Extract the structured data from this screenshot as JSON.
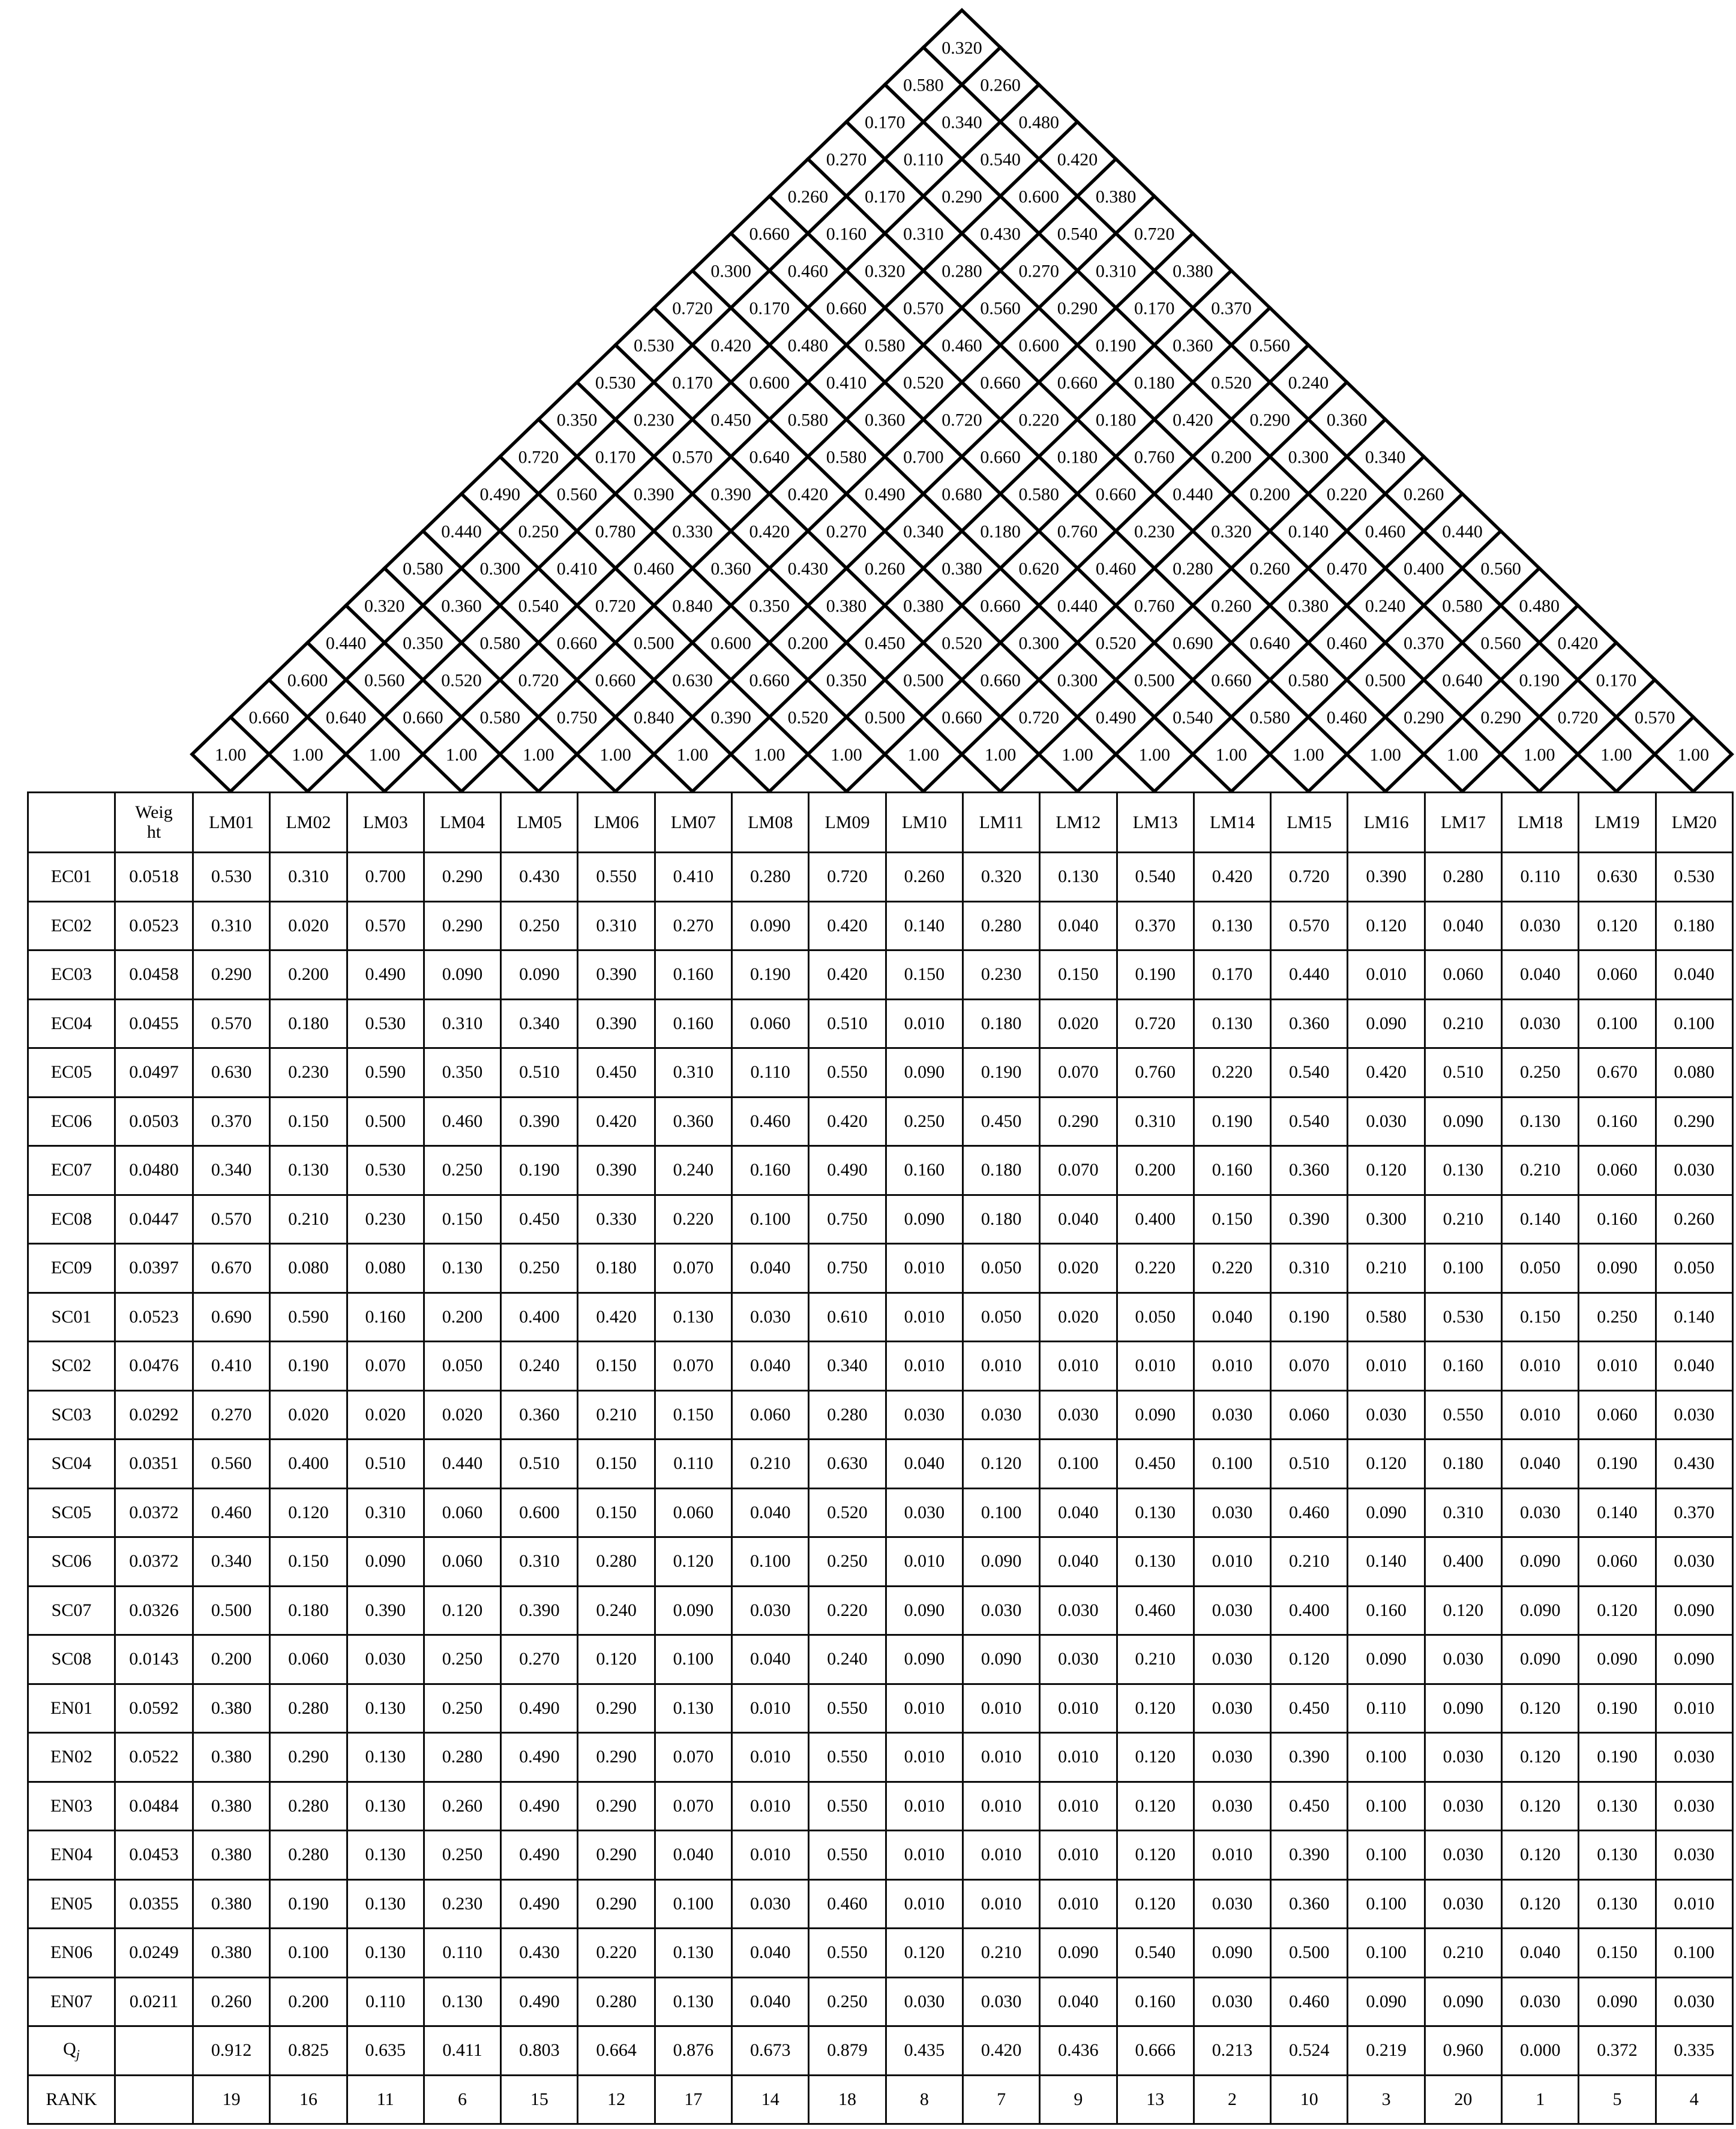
{
  "page": {
    "background": "#ffffff",
    "line_color": "#000000"
  },
  "roof": {
    "diagonal_label": "1.00",
    "rows_top_to_bottom": [
      [
        "0.320"
      ],
      [
        "0.580",
        "0.260"
      ],
      [
        "0.170",
        "0.340",
        "0.480"
      ],
      [
        "0.270",
        "0.110",
        "0.540",
        "0.420"
      ],
      [
        "0.260",
        "0.170",
        "0.290",
        "0.600",
        "0.380"
      ],
      [
        "0.660",
        "0.160",
        "0.310",
        "0.430",
        "0.540",
        "0.720"
      ],
      [
        "0.300",
        "0.460",
        "0.320",
        "0.280",
        "0.270",
        "0.310",
        "0.380"
      ],
      [
        "0.720",
        "0.170",
        "0.660",
        "0.570",
        "0.560",
        "0.290",
        "0.170",
        "0.370"
      ],
      [
        "0.530",
        "0.420",
        "0.480",
        "0.580",
        "0.460",
        "0.600",
        "0.190",
        "0.360",
        "0.560"
      ],
      [
        "0.530",
        "0.170",
        "0.600",
        "0.410",
        "0.520",
        "0.660",
        "0.660",
        "0.180",
        "0.520",
        "0.240"
      ],
      [
        "0.350",
        "0.230",
        "0.450",
        "0.580",
        "0.360",
        "0.720",
        "0.220",
        "0.180",
        "0.420",
        "0.290",
        "0.360"
      ],
      [
        "0.720",
        "0.170",
        "0.570",
        "0.640",
        "0.580",
        "0.700",
        "0.660",
        "0.180",
        "0.760",
        "0.200",
        "0.300",
        "0.340"
      ],
      [
        "0.490",
        "0.560",
        "0.390",
        "0.390",
        "0.420",
        "0.490",
        "0.680",
        "0.580",
        "0.660",
        "0.440",
        "0.200",
        "0.220",
        "0.260"
      ],
      [
        "0.440",
        "0.250",
        "0.780",
        "0.330",
        "0.420",
        "0.270",
        "0.340",
        "0.180",
        "0.760",
        "0.230",
        "0.320",
        "0.140",
        "0.460",
        "0.440"
      ],
      [
        "0.580",
        "0.300",
        "0.410",
        "0.460",
        "0.360",
        "0.430",
        "0.260",
        "0.380",
        "0.620",
        "0.460",
        "0.280",
        "0.260",
        "0.470",
        "0.400",
        "0.560"
      ],
      [
        "0.320",
        "0.360",
        "0.540",
        "0.720",
        "0.840",
        "0.350",
        "0.380",
        "0.380",
        "0.660",
        "0.440",
        "0.760",
        "0.260",
        "0.380",
        "0.240",
        "0.580",
        "0.480"
      ],
      [
        "0.440",
        "0.350",
        "0.580",
        "0.660",
        "0.500",
        "0.600",
        "0.200",
        "0.450",
        "0.520",
        "0.300",
        "0.520",
        "0.690",
        "0.640",
        "0.460",
        "0.370",
        "0.560",
        "0.420"
      ],
      [
        "0.600",
        "0.560",
        "0.520",
        "0.720",
        "0.660",
        "0.630",
        "0.660",
        "0.350",
        "0.500",
        "0.660",
        "0.300",
        "0.500",
        "0.660",
        "0.580",
        "0.500",
        "0.640",
        "0.190",
        "0.170"
      ],
      [
        "0.660",
        "0.640",
        "0.660",
        "0.580",
        "0.750",
        "0.840",
        "0.390",
        "0.520",
        "0.500",
        "0.660",
        "0.720",
        "0.490",
        "0.540",
        "0.580",
        "0.460",
        "0.290",
        "0.290",
        "0.720",
        "0.570"
      ]
    ],
    "base_row": [
      "1.00",
      "1.00",
      "1.00",
      "1.00",
      "1.00",
      "1.00",
      "1.00",
      "1.00",
      "1.00",
      "1.00",
      "1.00",
      "1.00",
      "1.00",
      "1.00",
      "1.00",
      "1.00",
      "1.00",
      "1.00",
      "1.00",
      "1.00"
    ]
  },
  "table": {
    "corner_label": "",
    "weight_header": "Weight",
    "column_headers": [
      "LM01",
      "LM02",
      "LM03",
      "LM04",
      "LM05",
      "LM06",
      "LM07",
      "LM08",
      "LM09",
      "LM10",
      "LM11",
      "LM12",
      "LM13",
      "LM14",
      "LM15",
      "LM16",
      "LM17",
      "LM18",
      "LM19",
      "LM20"
    ],
    "rows": [
      {
        "label": "EC01",
        "weight": "0.0518",
        "values": [
          "0.530",
          "0.310",
          "0.700",
          "0.290",
          "0.430",
          "0.550",
          "0.410",
          "0.280",
          "0.720",
          "0.260",
          "0.320",
          "0.130",
          "0.540",
          "0.420",
          "0.720",
          "0.390",
          "0.280",
          "0.110",
          "0.630",
          "0.530"
        ]
      },
      {
        "label": "EC02",
        "weight": "0.0523",
        "values": [
          "0.310",
          "0.020",
          "0.570",
          "0.290",
          "0.250",
          "0.310",
          "0.270",
          "0.090",
          "0.420",
          "0.140",
          "0.280",
          "0.040",
          "0.370",
          "0.130",
          "0.570",
          "0.120",
          "0.040",
          "0.030",
          "0.120",
          "0.180"
        ]
      },
      {
        "label": "EC03",
        "weight": "0.0458",
        "values": [
          "0.290",
          "0.200",
          "0.490",
          "0.090",
          "0.090",
          "0.390",
          "0.160",
          "0.190",
          "0.420",
          "0.150",
          "0.230",
          "0.150",
          "0.190",
          "0.170",
          "0.440",
          "0.010",
          "0.060",
          "0.040",
          "0.060",
          "0.040"
        ]
      },
      {
        "label": "EC04",
        "weight": "0.0455",
        "values": [
          "0.570",
          "0.180",
          "0.530",
          "0.310",
          "0.340",
          "0.390",
          "0.160",
          "0.060",
          "0.510",
          "0.010",
          "0.180",
          "0.020",
          "0.720",
          "0.130",
          "0.360",
          "0.090",
          "0.210",
          "0.030",
          "0.100",
          "0.100"
        ]
      },
      {
        "label": "EC05",
        "weight": "0.0497",
        "values": [
          "0.630",
          "0.230",
          "0.590",
          "0.350",
          "0.510",
          "0.450",
          "0.310",
          "0.110",
          "0.550",
          "0.090",
          "0.190",
          "0.070",
          "0.760",
          "0.220",
          "0.540",
          "0.420",
          "0.510",
          "0.250",
          "0.670",
          "0.080"
        ]
      },
      {
        "label": "EC06",
        "weight": "0.0503",
        "values": [
          "0.370",
          "0.150",
          "0.500",
          "0.460",
          "0.390",
          "0.420",
          "0.360",
          "0.460",
          "0.420",
          "0.250",
          "0.450",
          "0.290",
          "0.310",
          "0.190",
          "0.540",
          "0.030",
          "0.090",
          "0.130",
          "0.160",
          "0.290"
        ]
      },
      {
        "label": "EC07",
        "weight": "0.0480",
        "values": [
          "0.340",
          "0.130",
          "0.530",
          "0.250",
          "0.190",
          "0.390",
          "0.240",
          "0.160",
          "0.490",
          "0.160",
          "0.180",
          "0.070",
          "0.200",
          "0.160",
          "0.360",
          "0.120",
          "0.130",
          "0.210",
          "0.060",
          "0.030"
        ]
      },
      {
        "label": "EC08",
        "weight": "0.0447",
        "values": [
          "0.570",
          "0.210",
          "0.230",
          "0.150",
          "0.450",
          "0.330",
          "0.220",
          "0.100",
          "0.750",
          "0.090",
          "0.180",
          "0.040",
          "0.400",
          "0.150",
          "0.390",
          "0.300",
          "0.210",
          "0.140",
          "0.160",
          "0.260"
        ]
      },
      {
        "label": "EC09",
        "weight": "0.0397",
        "values": [
          "0.670",
          "0.080",
          "0.080",
          "0.130",
          "0.250",
          "0.180",
          "0.070",
          "0.040",
          "0.750",
          "0.010",
          "0.050",
          "0.020",
          "0.220",
          "0.220",
          "0.310",
          "0.210",
          "0.100",
          "0.050",
          "0.090",
          "0.050"
        ]
      },
      {
        "label": "SC01",
        "weight": "0.0523",
        "values": [
          "0.690",
          "0.590",
          "0.160",
          "0.200",
          "0.400",
          "0.420",
          "0.130",
          "0.030",
          "0.610",
          "0.010",
          "0.050",
          "0.020",
          "0.050",
          "0.040",
          "0.190",
          "0.580",
          "0.530",
          "0.150",
          "0.250",
          "0.140"
        ]
      },
      {
        "label": "SC02",
        "weight": "0.0476",
        "values": [
          "0.410",
          "0.190",
          "0.070",
          "0.050",
          "0.240",
          "0.150",
          "0.070",
          "0.040",
          "0.340",
          "0.010",
          "0.010",
          "0.010",
          "0.010",
          "0.010",
          "0.070",
          "0.010",
          "0.160",
          "0.010",
          "0.010",
          "0.040"
        ]
      },
      {
        "label": "SC03",
        "weight": "0.0292",
        "values": [
          "0.270",
          "0.020",
          "0.020",
          "0.020",
          "0.360",
          "0.210",
          "0.150",
          "0.060",
          "0.280",
          "0.030",
          "0.030",
          "0.030",
          "0.090",
          "0.030",
          "0.060",
          "0.030",
          "0.550",
          "0.010",
          "0.060",
          "0.030"
        ]
      },
      {
        "label": "SC04",
        "weight": "0.0351",
        "values": [
          "0.560",
          "0.400",
          "0.510",
          "0.440",
          "0.510",
          "0.150",
          "0.110",
          "0.210",
          "0.630",
          "0.040",
          "0.120",
          "0.100",
          "0.450",
          "0.100",
          "0.510",
          "0.120",
          "0.180",
          "0.040",
          "0.190",
          "0.430"
        ]
      },
      {
        "label": "SC05",
        "weight": "0.0372",
        "values": [
          "0.460",
          "0.120",
          "0.310",
          "0.060",
          "0.600",
          "0.150",
          "0.060",
          "0.040",
          "0.520",
          "0.030",
          "0.100",
          "0.040",
          "0.130",
          "0.030",
          "0.460",
          "0.090",
          "0.310",
          "0.030",
          "0.140",
          "0.370"
        ]
      },
      {
        "label": "SC06",
        "weight": "0.0372",
        "values": [
          "0.340",
          "0.150",
          "0.090",
          "0.060",
          "0.310",
          "0.280",
          "0.120",
          "0.100",
          "0.250",
          "0.010",
          "0.090",
          "0.040",
          "0.130",
          "0.010",
          "0.210",
          "0.140",
          "0.400",
          "0.090",
          "0.060",
          "0.030"
        ]
      },
      {
        "label": "SC07",
        "weight": "0.0326",
        "values": [
          "0.500",
          "0.180",
          "0.390",
          "0.120",
          "0.390",
          "0.240",
          "0.090",
          "0.030",
          "0.220",
          "0.090",
          "0.030",
          "0.030",
          "0.460",
          "0.030",
          "0.400",
          "0.160",
          "0.120",
          "0.090",
          "0.120",
          "0.090"
        ]
      },
      {
        "label": "SC08",
        "weight": "0.0143",
        "values": [
          "0.200",
          "0.060",
          "0.030",
          "0.250",
          "0.270",
          "0.120",
          "0.100",
          "0.040",
          "0.240",
          "0.090",
          "0.090",
          "0.030",
          "0.210",
          "0.030",
          "0.120",
          "0.090",
          "0.030",
          "0.090",
          "0.090",
          "0.090"
        ]
      },
      {
        "label": "EN01",
        "weight": "0.0592",
        "values": [
          "0.380",
          "0.280",
          "0.130",
          "0.250",
          "0.490",
          "0.290",
          "0.130",
          "0.010",
          "0.550",
          "0.010",
          "0.010",
          "0.010",
          "0.120",
          "0.030",
          "0.450",
          "0.110",
          "0.090",
          "0.120",
          "0.190",
          "0.010"
        ]
      },
      {
        "label": "EN02",
        "weight": "0.0522",
        "values": [
          "0.380",
          "0.290",
          "0.130",
          "0.280",
          "0.490",
          "0.290",
          "0.070",
          "0.010",
          "0.550",
          "0.010",
          "0.010",
          "0.010",
          "0.120",
          "0.030",
          "0.390",
          "0.100",
          "0.030",
          "0.120",
          "0.190",
          "0.030"
        ]
      },
      {
        "label": "EN03",
        "weight": "0.0484",
        "values": [
          "0.380",
          "0.280",
          "0.130",
          "0.260",
          "0.490",
          "0.290",
          "0.070",
          "0.010",
          "0.550",
          "0.010",
          "0.010",
          "0.010",
          "0.120",
          "0.030",
          "0.450",
          "0.100",
          "0.030",
          "0.120",
          "0.130",
          "0.030"
        ]
      },
      {
        "label": "EN04",
        "weight": "0.0453",
        "values": [
          "0.380",
          "0.280",
          "0.130",
          "0.250",
          "0.490",
          "0.290",
          "0.040",
          "0.010",
          "0.550",
          "0.010",
          "0.010",
          "0.010",
          "0.120",
          "0.010",
          "0.390",
          "0.100",
          "0.030",
          "0.120",
          "0.130",
          "0.030"
        ]
      },
      {
        "label": "EN05",
        "weight": "0.0355",
        "values": [
          "0.380",
          "0.190",
          "0.130",
          "0.230",
          "0.490",
          "0.290",
          "0.100",
          "0.030",
          "0.460",
          "0.010",
          "0.010",
          "0.010",
          "0.120",
          "0.030",
          "0.360",
          "0.100",
          "0.030",
          "0.120",
          "0.130",
          "0.010"
        ]
      },
      {
        "label": "EN06",
        "weight": "0.0249",
        "values": [
          "0.380",
          "0.100",
          "0.130",
          "0.110",
          "0.430",
          "0.220",
          "0.130",
          "0.040",
          "0.550",
          "0.120",
          "0.210",
          "0.090",
          "0.540",
          "0.090",
          "0.500",
          "0.100",
          "0.210",
          "0.040",
          "0.150",
          "0.100"
        ]
      },
      {
        "label": "EN07",
        "weight": "0.0211",
        "values": [
          "0.260",
          "0.200",
          "0.110",
          "0.130",
          "0.490",
          "0.280",
          "0.130",
          "0.040",
          "0.250",
          "0.030",
          "0.030",
          "0.040",
          "0.160",
          "0.030",
          "0.460",
          "0.090",
          "0.090",
          "0.030",
          "0.090",
          "0.030"
        ]
      }
    ],
    "score_row": {
      "label_base": "Q",
      "label_sub": "j",
      "weight": "",
      "values": [
        "0.912",
        "0.825",
        "0.635",
        "0.411",
        "0.803",
        "0.664",
        "0.876",
        "0.673",
        "0.879",
        "0.435",
        "0.420",
        "0.436",
        "0.666",
        "0.213",
        "0.524",
        "0.219",
        "0.960",
        "0.000",
        "0.372",
        "0.335"
      ]
    },
    "rank_row": {
      "label": "RANK",
      "weight": "",
      "values": [
        "19",
        "16",
        "11",
        "6",
        "15",
        "12",
        "17",
        "14",
        "18",
        "8",
        "7",
        "9",
        "13",
        "2",
        "10",
        "3",
        "20",
        "1",
        "5",
        "4"
      ],
      "bold": [
        false,
        false,
        false,
        false,
        false,
        false,
        false,
        false,
        false,
        false,
        false,
        false,
        false,
        true,
        false,
        true,
        false,
        true,
        true,
        true
      ]
    }
  }
}
